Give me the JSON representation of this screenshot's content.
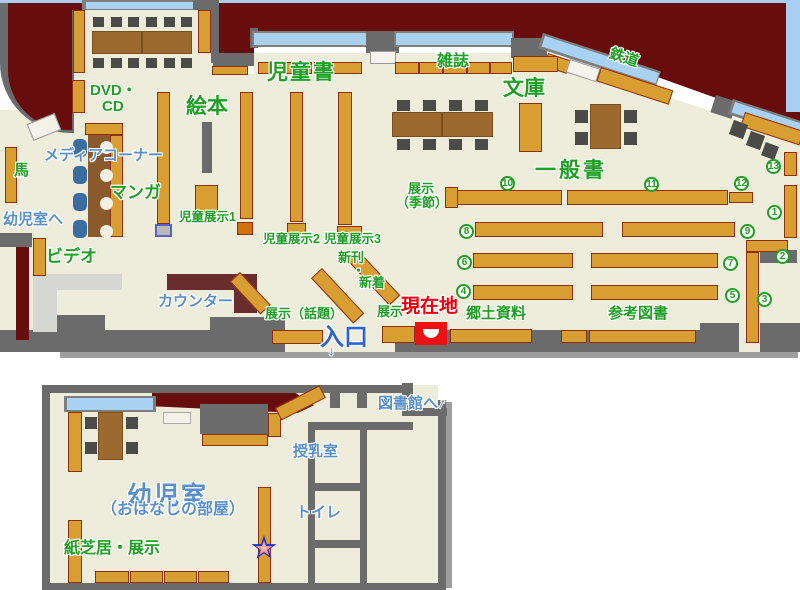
{
  "map_title": "library-floor-map",
  "labels": {
    "dvd_line1": "DVD・",
    "dvd_line2": "CD",
    "ehon": "絵本",
    "jidosho": "児童書",
    "zasshi": "雑誌",
    "bunko": "文庫",
    "tetsudo": "鉄道",
    "ippansho": "一般書",
    "tenji_kisetsu_line1": "展示",
    "tenji_kisetsu_line2": "（季節）",
    "media_corner": "メディアコーナー",
    "manga": "マンガ",
    "uma": "馬",
    "yojishitsu_e": "幼児室へ",
    "video": "ビデオ",
    "counter": "カウンター",
    "jido_tenji_1": "児童展示1",
    "jido_tenji_2": "児童展示2",
    "jido_tenji_3": "児童展示3",
    "shinkan": "新刊",
    "nakaguro": "・",
    "shinchaku": "新着",
    "tenji_wadai": "展示（話題）",
    "tenji": "展示",
    "genzaichi": "現在地",
    "iriguchi": "入口",
    "kyodo_shiryo": "郷土資料",
    "sanko_tosho": "参考図書",
    "toshokan_e": "図書館へ",
    "junyushitsu": "授乳室",
    "toire": "トイレ",
    "yojishitsu": "幼児室",
    "ohanashi_no_heya": "（おはなしの部屋）",
    "kamishibai_tenji": "紙芝居・展示"
  },
  "shelf_numbers": [
    "1",
    "2",
    "3",
    "4",
    "5",
    "6",
    "7",
    "8",
    "9",
    "10",
    "11",
    "12",
    "13"
  ],
  "icons": {
    "up_arrow": "↑",
    "down_arrow": "↓"
  },
  "colors": {
    "exterior_dark_red": "#670d0d",
    "floor_cream": "#eeeddc",
    "wall_gray": "#6b6b6b",
    "shelf_gold": "#d89e32",
    "shelf_border": "#8e2f10",
    "table_brown": "#9c6a2e",
    "chair_dark": "#4b4b47",
    "window_blue": "#a9d1f2",
    "counter_maroon": "#6a2d2d",
    "label_green": "#1f9e26",
    "label_blue": "#5b8fc9",
    "entrance_blue": "#2f62d6",
    "current_location_red": "#e8000d",
    "marker_box_red": "#ee1111",
    "media_chair_blue": "#3a6ea0",
    "star_outline_blue": "#1f2fd0",
    "star_fill_pink": "#f08878",
    "page_edge_blue": "#a8cef5"
  }
}
